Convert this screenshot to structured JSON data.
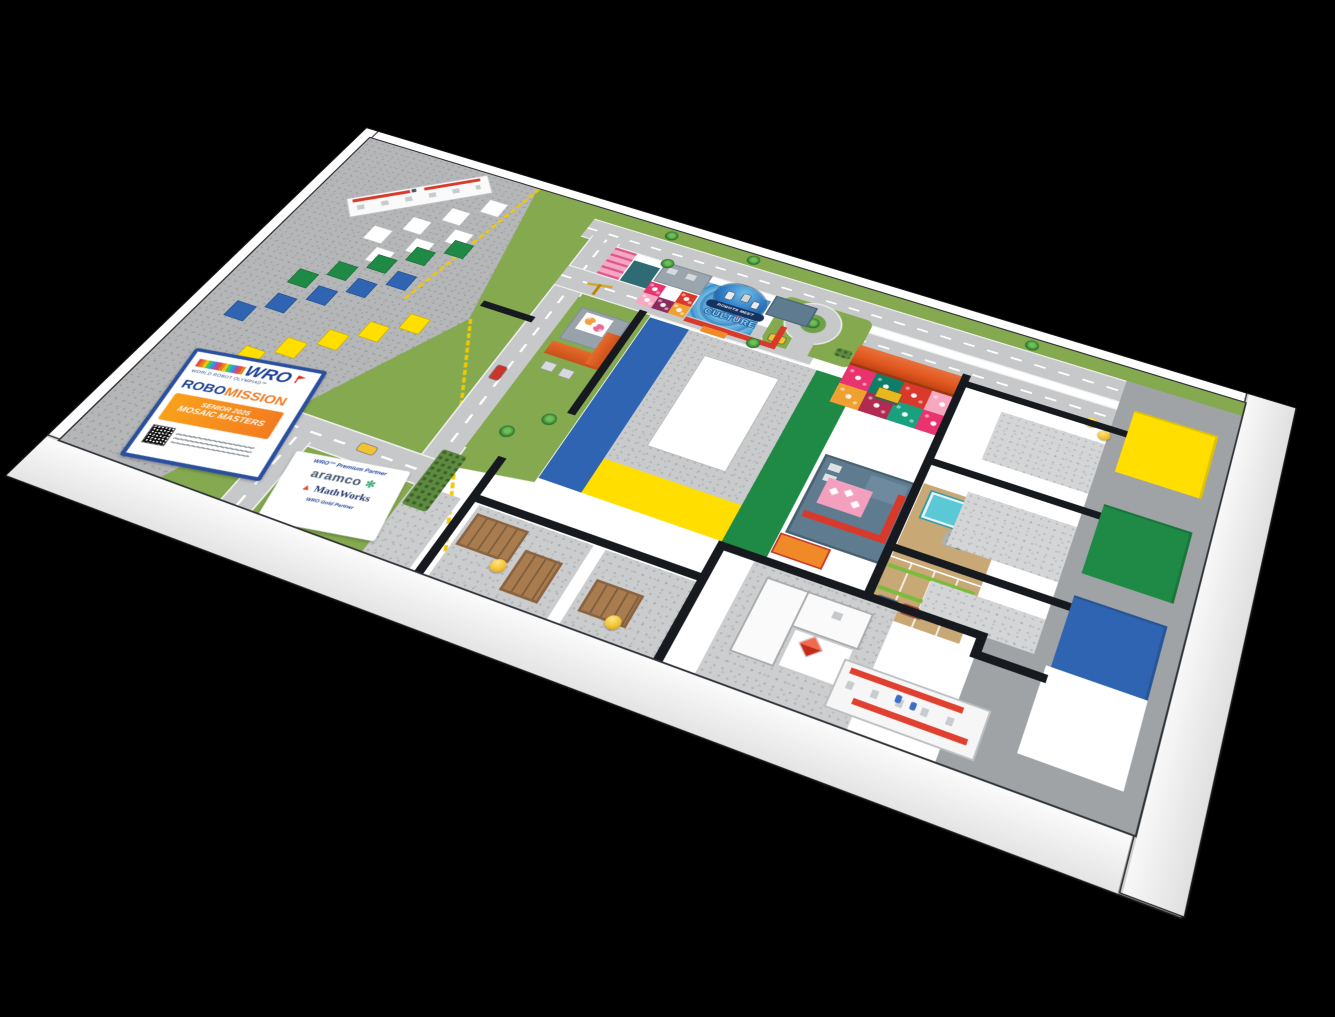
{
  "scene": {
    "description": "WRO RoboMission competition table, 3D view",
    "background": "#000000"
  },
  "wro_panel": {
    "org": "WRO",
    "tagline": "WORLD ROBOT OLYMPIAD™",
    "program_left": "ROBO",
    "program_right": "MISSION",
    "banner_line1": "SENIOR 2025",
    "banner_line2": "MOSAIC MASTERS"
  },
  "sponsor_panel": {
    "heading": "WRO™ Premium Partner",
    "sponsor_1": "aramco",
    "sponsor_1_mark": "✻",
    "sponsor_2": "MathWorks",
    "sponsor_2_mark": "▲",
    "footer": "WRO Gold Partner"
  },
  "season_logo": {
    "line1": "ROBOTS MEET",
    "line2": "CULTURE"
  },
  "colors": {
    "blue": "#2E64B2",
    "green": "#1F8A45",
    "yellow": "#FFDE00",
    "red": "#D9392B",
    "orange": "#F08A28",
    "orange-roof": "#E0551E",
    "road": "#C6C8C9",
    "grass": "#84A94F",
    "grass-dark": "#5C8A3F",
    "cobble": "#B4B6B8",
    "line": "#161A1F",
    "tan": "#C8A874",
    "pool": "#5BC8D6",
    "grayband": "#9FA3A6",
    "speckle": "#D4D5D6",
    "plaza": "#CBCCCE",
    "wood": "#A97C50",
    "wood-dark": "#8A6340",
    "ball": "#F2C230",
    "wall": "#FFFFFF",
    "navy": "#1B3F94",
    "pink": "#F2A7C3",
    "hotpink": "#E8336E",
    "teal": "#2E6B74",
    "bluegray": "#5E7B90"
  },
  "game_elements": {
    "tile_rows": [
      {
        "color": "white",
        "count": 7
      },
      {
        "color": "green",
        "count": 5
      },
      {
        "color": "blue",
        "count": 5
      },
      {
        "color": "yellow",
        "count": 5
      }
    ],
    "mosaic_frames": [
      "yellow",
      "green",
      "blue"
    ],
    "plaza_border_bands": [
      "blue",
      "yellow",
      "green"
    ],
    "yellow_balls": 4,
    "vehicles": [
      "taxi",
      "taxi",
      "red-car",
      "blue-car",
      "red-car",
      "red-car",
      "bulldozer",
      "crane"
    ]
  }
}
